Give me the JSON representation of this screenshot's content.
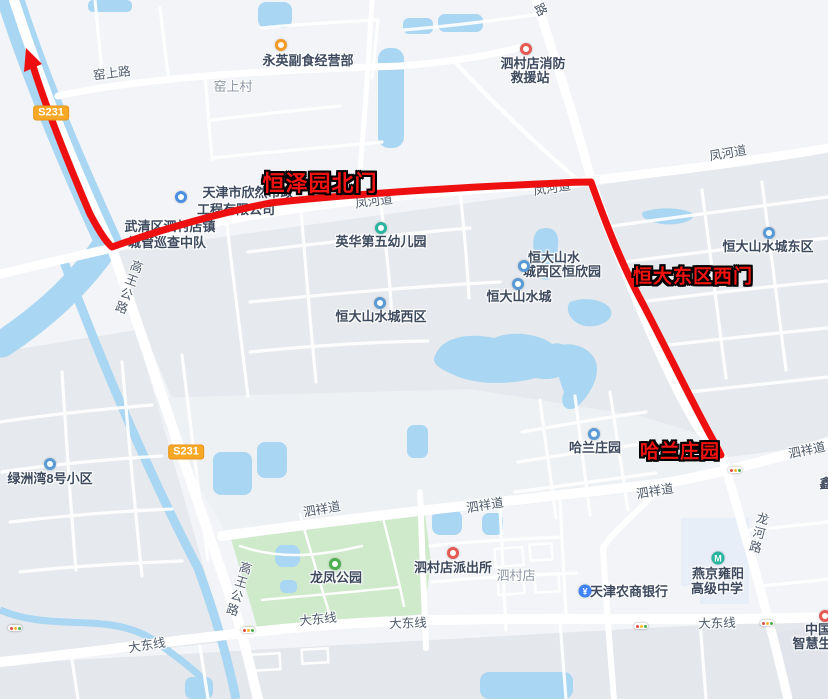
{
  "map": {
    "colors": {
      "route_red": "#ee1010",
      "water_blue": "#a9d6f2",
      "park_green": "#cfe9cb",
      "badge_yellow": "#f9a825",
      "poi_text": "#3d4a5e",
      "road_text": "#4e5a6b",
      "area_text": "#8e97a4",
      "red_label": "#f2120f"
    },
    "route_labels": [
      {
        "t": "恒泽园北门",
        "x": 320,
        "y": 182,
        "s": 22
      },
      {
        "t": "恒大东区西门",
        "x": 693,
        "y": 275,
        "s": 19
      },
      {
        "t": "哈兰庄园",
        "x": 680,
        "y": 450,
        "s": 19
      }
    ],
    "badges": [
      {
        "t": "S231",
        "x": 51,
        "y": 113
      },
      {
        "t": "S231",
        "x": 186,
        "y": 452
      }
    ],
    "labels": [
      {
        "t": "窑上路",
        "x": 112,
        "y": 74,
        "c": "road",
        "r": -7
      },
      {
        "t": "窑上村",
        "x": 233,
        "y": 87,
        "c": "area"
      },
      {
        "t": "永英副食经营部",
        "x": 308,
        "y": 61,
        "c": "poi"
      },
      {
        "t": "泗村店消防",
        "x": 533,
        "y": 64,
        "c": "poi"
      },
      {
        "t": "救援站",
        "x": 530,
        "y": 78,
        "c": "poi"
      },
      {
        "t": "路",
        "x": 540,
        "y": 10,
        "c": "road",
        "r": 62
      },
      {
        "t": "凤河道",
        "x": 728,
        "y": 154,
        "c": "road",
        "r": -10
      },
      {
        "t": "凤河道",
        "x": 374,
        "y": 202,
        "c": "road",
        "r": -7
      },
      {
        "t": "凤河道",
        "x": 552,
        "y": 189,
        "c": "road",
        "r": -9
      },
      {
        "t": "天津市欣然市政",
        "x": 248,
        "y": 193,
        "c": "poi"
      },
      {
        "t": "工程有限公司",
        "x": 236,
        "y": 210,
        "c": "poi"
      },
      {
        "t": "武清区泗村店镇",
        "x": 170,
        "y": 227,
        "c": "poi"
      },
      {
        "t": "城管巡查中队",
        "x": 167,
        "y": 243,
        "c": "poi"
      },
      {
        "t": "高王公路",
        "x": 127,
        "y": 287,
        "c": "roadv",
        "r": 20
      },
      {
        "t": "英华第五幼儿园",
        "x": 381,
        "y": 242,
        "c": "poi"
      },
      {
        "t": "恒大山水城东区",
        "x": 768,
        "y": 247,
        "c": "poi"
      },
      {
        "t": "恒大山水",
        "x": 554,
        "y": 258,
        "c": "poi"
      },
      {
        "t": "城西区恒欣园",
        "x": 562,
        "y": 272,
        "c": "poi"
      },
      {
        "t": "恒大山水城",
        "x": 519,
        "y": 297,
        "c": "poi"
      },
      {
        "t": "恒大山水城西区",
        "x": 381,
        "y": 317,
        "c": "poi"
      },
      {
        "t": "哈兰庄园",
        "x": 595,
        "y": 448,
        "c": "poi"
      },
      {
        "t": "泗祥道",
        "x": 807,
        "y": 451,
        "c": "road",
        "r": -12
      },
      {
        "t": "泗祥道",
        "x": 655,
        "y": 492,
        "c": "road",
        "r": -9
      },
      {
        "t": "泗祥道",
        "x": 485,
        "y": 506,
        "c": "road",
        "r": -9
      },
      {
        "t": "泗祥道",
        "x": 322,
        "y": 510,
        "c": "road",
        "r": -10
      },
      {
        "t": "绿洲湾8号小区",
        "x": 50,
        "y": 479,
        "c": "poi"
      },
      {
        "t": "龙凤公园",
        "x": 336,
        "y": 578,
        "c": "poi"
      },
      {
        "t": "泗村店派出所",
        "x": 453,
        "y": 568,
        "c": "poi"
      },
      {
        "t": "泗村店",
        "x": 516,
        "y": 576,
        "c": "area"
      },
      {
        "t": "高王公路",
        "x": 237,
        "y": 589,
        "c": "roadv",
        "r": 17
      },
      {
        "t": "龙河路",
        "x": 757,
        "y": 533,
        "c": "roadv",
        "r": 14
      },
      {
        "t": "大东线",
        "x": 147,
        "y": 646,
        "c": "road",
        "r": -9
      },
      {
        "t": "大东线",
        "x": 318,
        "y": 620,
        "c": "road",
        "r": -6
      },
      {
        "t": "大东线",
        "x": 408,
        "y": 624,
        "c": "road",
        "r": -2
      },
      {
        "t": "大东线",
        "x": 717,
        "y": 624,
        "c": "road",
        "r": -2
      },
      {
        "t": "天津农商银行",
        "x": 629,
        "y": 592,
        "c": "poi"
      },
      {
        "t": "燕京雍阳",
        "x": 718,
        "y": 574,
        "c": "poi"
      },
      {
        "t": "高级中学",
        "x": 717,
        "y": 589,
        "c": "poi"
      },
      {
        "t": "中国",
        "x": 818,
        "y": 630,
        "c": "poi"
      },
      {
        "t": "智慧生",
        "x": 812,
        "y": 644,
        "c": "poi"
      },
      {
        "t": "鑫",
        "x": 826,
        "y": 484,
        "c": "poi"
      }
    ],
    "icons": [
      {
        "k": "shop-icon",
        "x": 281,
        "y": 45,
        "type": "ring",
        "color": "#f59a23"
      },
      {
        "k": "fire-station-icon",
        "x": 526,
        "y": 49,
        "type": "ring",
        "color": "#e65a54"
      },
      {
        "k": "company-icon",
        "x": 181,
        "y": 197,
        "type": "ring",
        "color": "#4a90e2"
      },
      {
        "k": "kindergarten-icon",
        "x": 381,
        "y": 228,
        "type": "ring",
        "color": "#2bb5a0"
      },
      {
        "k": "residence-icon",
        "x": 769,
        "y": 233,
        "type": "ring",
        "color": "#5b9bd5"
      },
      {
        "k": "residence-icon",
        "x": 524,
        "y": 266,
        "type": "ring",
        "color": "#5b9bd5"
      },
      {
        "k": "residence-icon",
        "x": 518,
        "y": 284,
        "type": "ring",
        "color": "#5b9bd5"
      },
      {
        "k": "residence-icon",
        "x": 380,
        "y": 303,
        "type": "ring",
        "color": "#5b9bd5"
      },
      {
        "k": "residence-icon",
        "x": 594,
        "y": 434,
        "type": "ring",
        "color": "#5b9bd5"
      },
      {
        "k": "residence-icon",
        "x": 50,
        "y": 464,
        "type": "ring",
        "color": "#5b9bd5"
      },
      {
        "k": "park-icon",
        "x": 335,
        "y": 564,
        "type": "ring",
        "color": "#4caf50"
      },
      {
        "k": "police-icon",
        "x": 453,
        "y": 553,
        "type": "ring",
        "color": "#e65a54"
      },
      {
        "k": "bank-icon",
        "x": 585,
        "y": 591,
        "type": "glyph",
        "color": "#3f83f8",
        "glyph": "¥"
      },
      {
        "k": "school-icon",
        "x": 718,
        "y": 558,
        "type": "glyph",
        "color": "#2bb5a0",
        "glyph": "M"
      },
      {
        "k": "hospital-icon",
        "x": 825,
        "y": 616,
        "type": "ring",
        "color": "#e65a54"
      }
    ],
    "traffic_lights": [
      {
        "x": 735,
        "y": 470
      },
      {
        "x": 641,
        "y": 626
      },
      {
        "x": 767,
        "y": 623
      },
      {
        "x": 248,
        "y": 630
      },
      {
        "x": 15,
        "y": 628
      }
    ],
    "traffic_light_colors": [
      "#e05043",
      "#f5b82e",
      "#4cae4f"
    ]
  }
}
